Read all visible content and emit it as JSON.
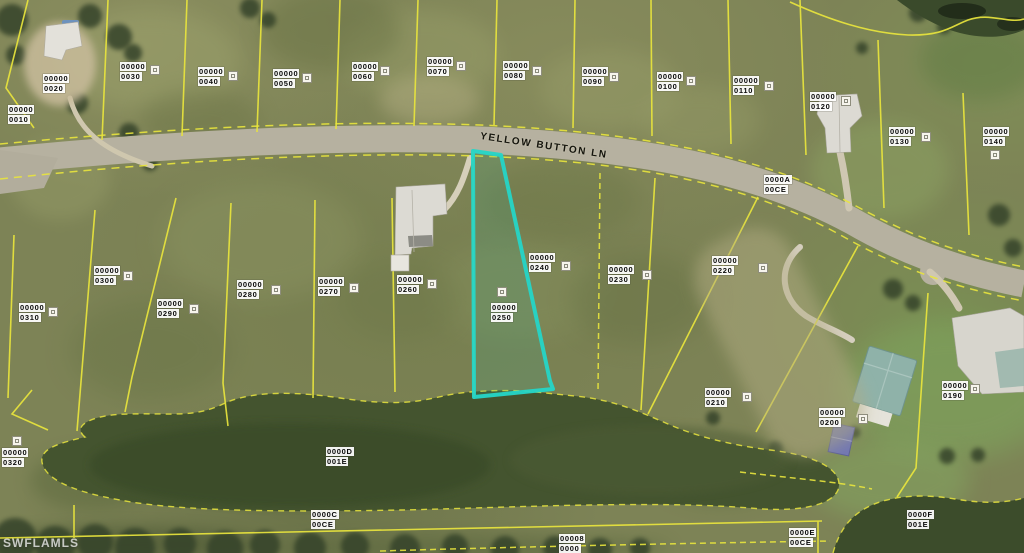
{
  "map": {
    "street_label": "YELLOW BUTTON LN",
    "watermark": "SWFLAMLS",
    "highlight_color": "#25d6c8",
    "parcel_line_color": "#e9e53d",
    "water_color": "#44542f",
    "road_color": "#b6b1a0",
    "highlighted_parcel": {
      "block": "00000",
      "lot": "0250"
    },
    "parcels": [
      {
        "block": "00000",
        "lot": "0010",
        "x": 8,
        "y": 105
      },
      {
        "block": "00000",
        "lot": "0020",
        "x": 43,
        "y": 74
      },
      {
        "block": "00000",
        "lot": "0030",
        "x": 120,
        "y": 62
      },
      {
        "block": "00000",
        "lot": "0040",
        "x": 198,
        "y": 67
      },
      {
        "block": "00000",
        "lot": "0050",
        "x": 273,
        "y": 69
      },
      {
        "block": "00000",
        "lot": "0060",
        "x": 352,
        "y": 62
      },
      {
        "block": "00000",
        "lot": "0070",
        "x": 427,
        "y": 57
      },
      {
        "block": "00000",
        "lot": "0080",
        "x": 503,
        "y": 61
      },
      {
        "block": "00000",
        "lot": "0090",
        "x": 582,
        "y": 67
      },
      {
        "block": "00000",
        "lot": "0100",
        "x": 657,
        "y": 72
      },
      {
        "block": "00000",
        "lot": "0110",
        "x": 733,
        "y": 76
      },
      {
        "block": "00000",
        "lot": "0120",
        "x": 810,
        "y": 92
      },
      {
        "block": "00000",
        "lot": "0130",
        "x": 889,
        "y": 127
      },
      {
        "block": "00000",
        "lot": "0140",
        "x": 983,
        "y": 127
      },
      {
        "block": "0000A",
        "lot": "00CE",
        "x": 764,
        "y": 175
      },
      {
        "block": "00000",
        "lot": "0300",
        "x": 94,
        "y": 266
      },
      {
        "block": "00000",
        "lot": "0310",
        "x": 19,
        "y": 303
      },
      {
        "block": "00000",
        "lot": "0290",
        "x": 157,
        "y": 299
      },
      {
        "block": "00000",
        "lot": "0280",
        "x": 237,
        "y": 280
      },
      {
        "block": "00000",
        "lot": "0270",
        "x": 318,
        "y": 277
      },
      {
        "block": "00000",
        "lot": "0260",
        "x": 397,
        "y": 275
      },
      {
        "block": "00000",
        "lot": "0240",
        "x": 529,
        "y": 253
      },
      {
        "block": "00000",
        "lot": "0250",
        "x": 491,
        "y": 303
      },
      {
        "block": "00000",
        "lot": "0230",
        "x": 608,
        "y": 265
      },
      {
        "block": "00000",
        "lot": "0220",
        "x": 712,
        "y": 256
      },
      {
        "block": "00000",
        "lot": "0210",
        "x": 705,
        "y": 388
      },
      {
        "block": "00000",
        "lot": "0200",
        "x": 819,
        "y": 408
      },
      {
        "block": "00000",
        "lot": "0190",
        "x": 942,
        "y": 381
      },
      {
        "block": "00000",
        "lot": "0320",
        "x": 2,
        "y": 448
      },
      {
        "block": "0000D",
        "lot": "001E",
        "x": 326,
        "y": 447
      },
      {
        "block": "0000C",
        "lot": "00CE",
        "x": 311,
        "y": 510
      },
      {
        "block": "00008",
        "lot": "0000",
        "x": 559,
        "y": 534
      },
      {
        "block": "0000E",
        "lot": "00CE",
        "x": 789,
        "y": 528
      },
      {
        "block": "0000F",
        "lot": "001E",
        "x": 907,
        "y": 510
      }
    ],
    "markers": [
      [
        150,
        65
      ],
      [
        228,
        71
      ],
      [
        302,
        73
      ],
      [
        380,
        66
      ],
      [
        456,
        61
      ],
      [
        532,
        66
      ],
      [
        609,
        72
      ],
      [
        686,
        76
      ],
      [
        764,
        81
      ],
      [
        841,
        96
      ],
      [
        921,
        132
      ],
      [
        990,
        150
      ],
      [
        123,
        271
      ],
      [
        48,
        307
      ],
      [
        189,
        304
      ],
      [
        271,
        285
      ],
      [
        349,
        283
      ],
      [
        427,
        279
      ],
      [
        561,
        261
      ],
      [
        642,
        270
      ],
      [
        758,
        263
      ],
      [
        497,
        287
      ],
      [
        742,
        392
      ],
      [
        858,
        414
      ],
      [
        970,
        384
      ],
      [
        12,
        436
      ]
    ]
  }
}
